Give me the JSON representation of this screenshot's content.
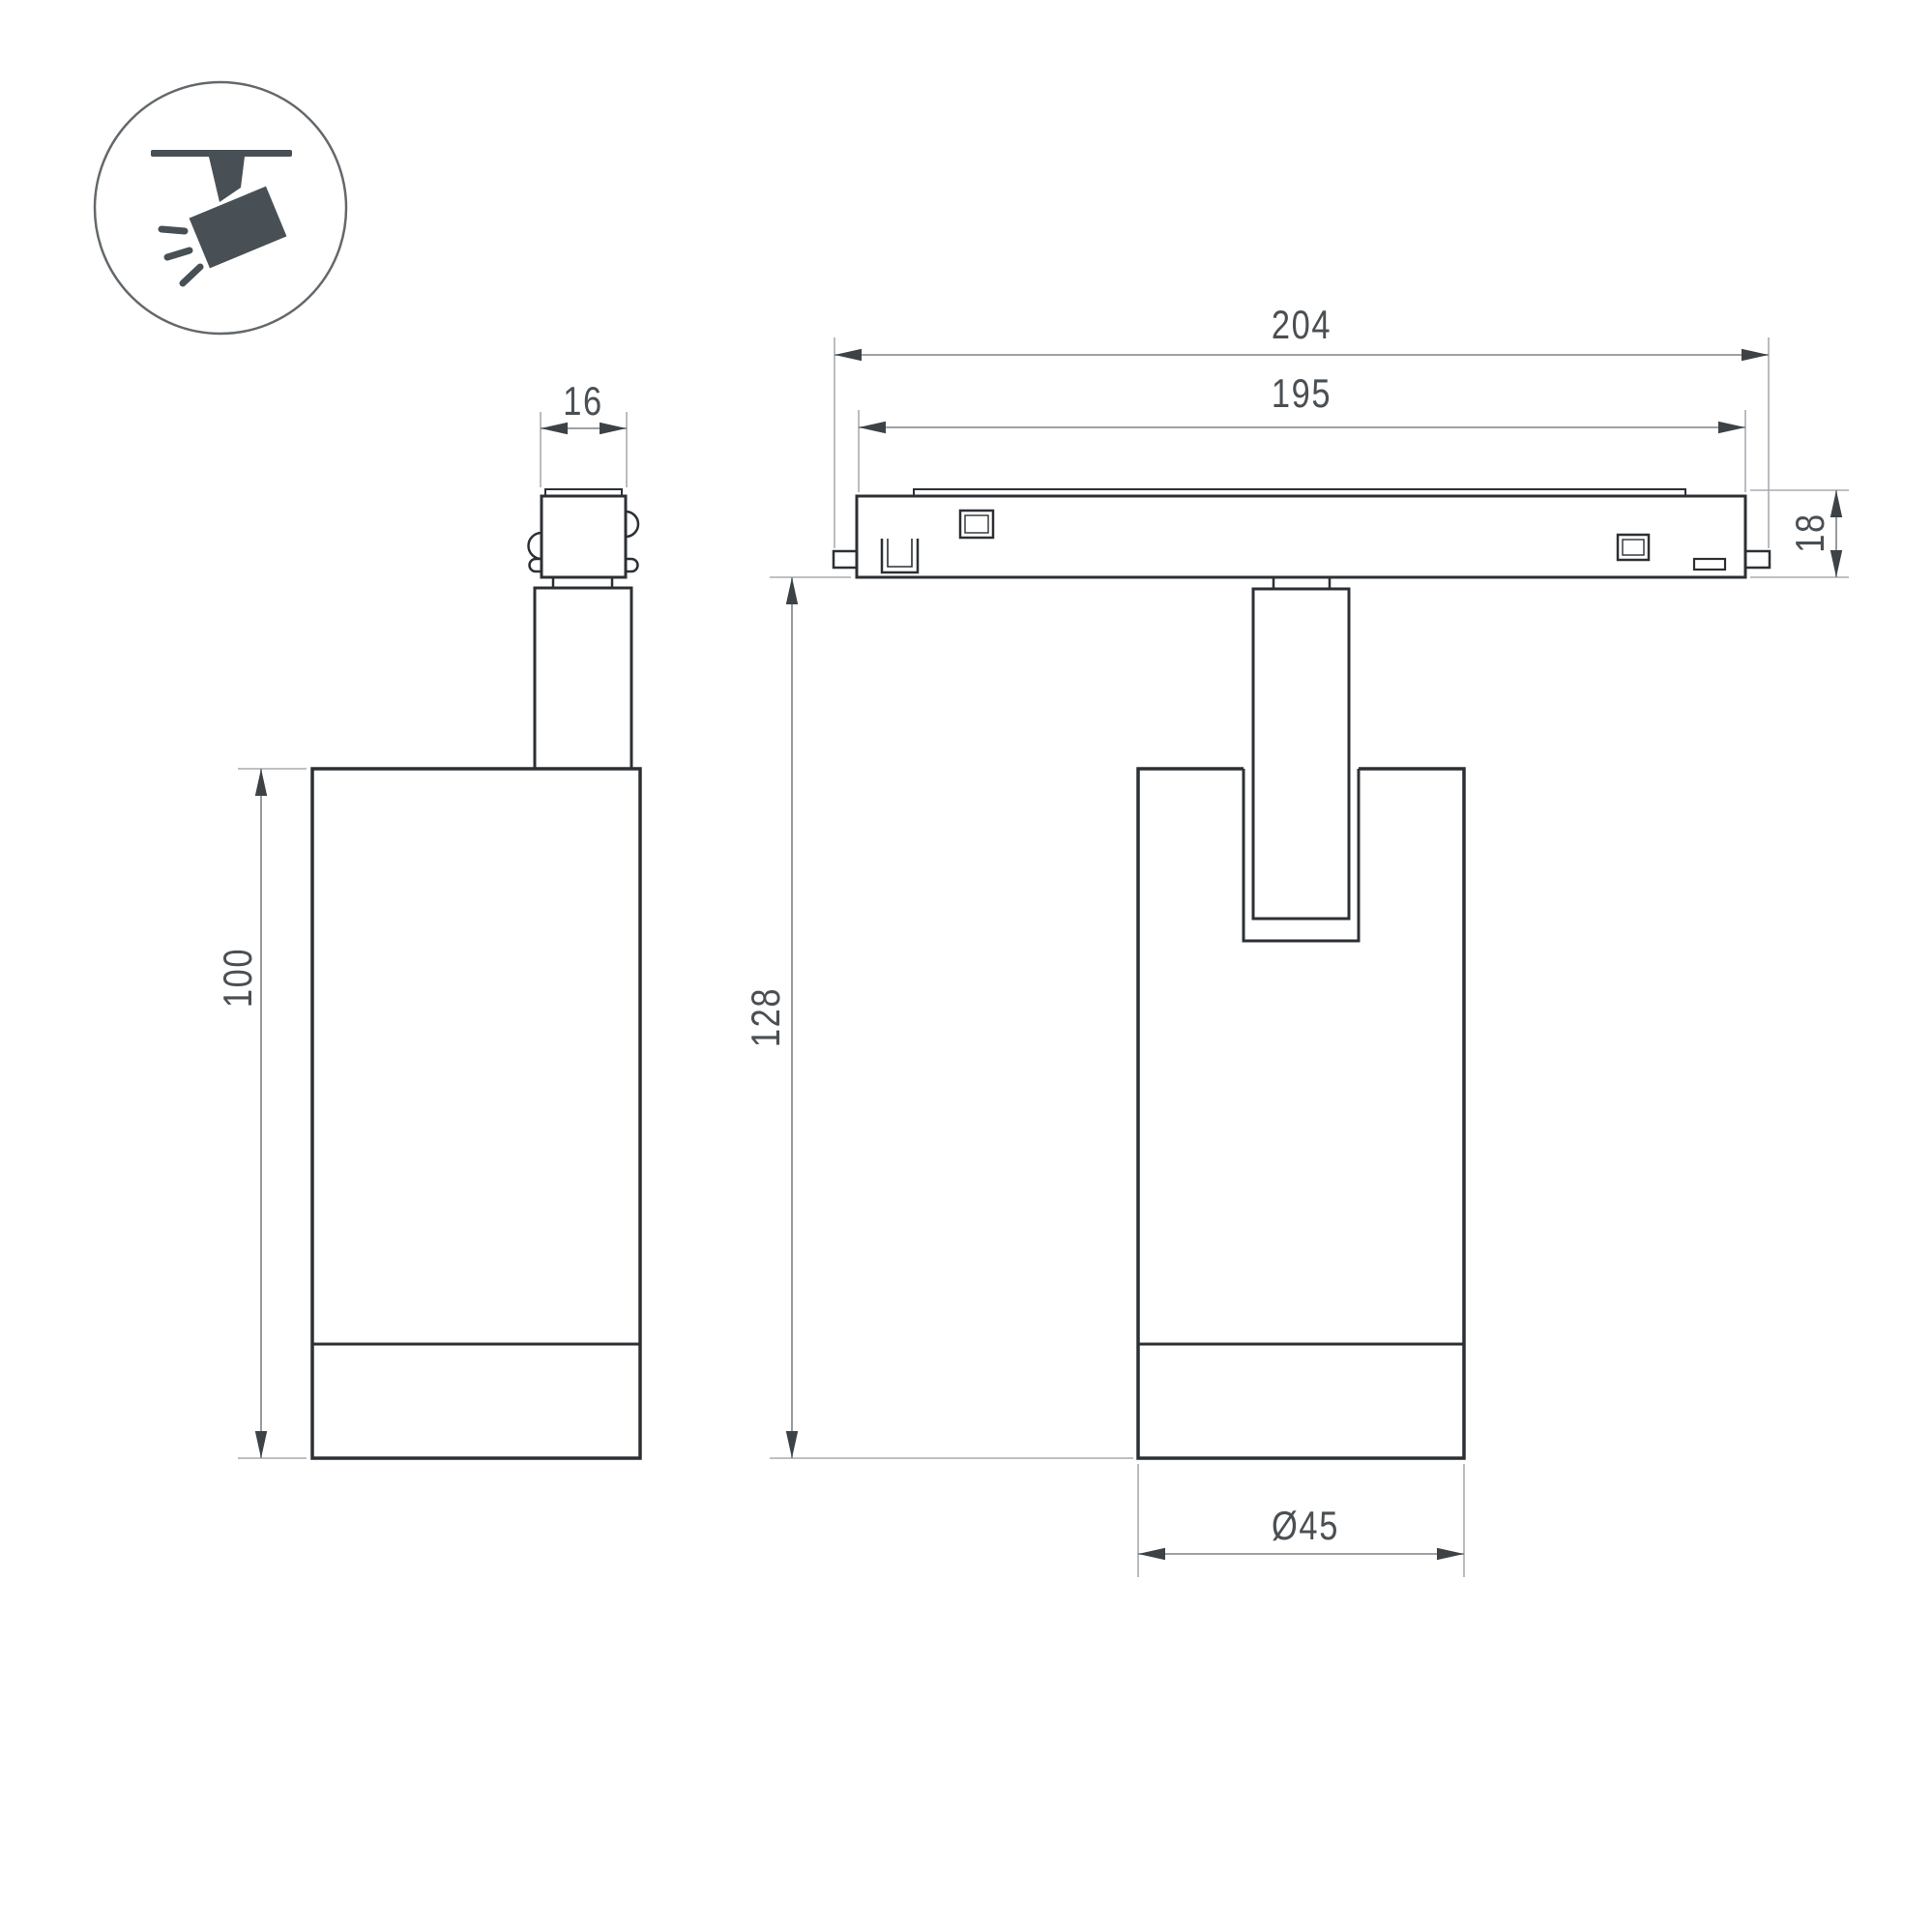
{
  "title": "ceiling-track-spotlight-technical-drawing",
  "icon": {
    "meaning": "track-mounted-spotlight-pictogram",
    "color": "#485055",
    "circle_outline": "#63686c"
  },
  "drawing": {
    "outline_color": "#2c3034",
    "dimension_line_color": "#7e8286",
    "extension_line_color": "#a8acb0",
    "arrow_color": "#3d4246",
    "text_color": "#4a4f53",
    "background": "#ffffff"
  },
  "dimensions": {
    "side_width": "16",
    "side_height": "100",
    "track_length_total": "204",
    "track_length_body": "195",
    "track_height": "18",
    "fixture_height": "128",
    "body_diameter": "Ø45"
  }
}
